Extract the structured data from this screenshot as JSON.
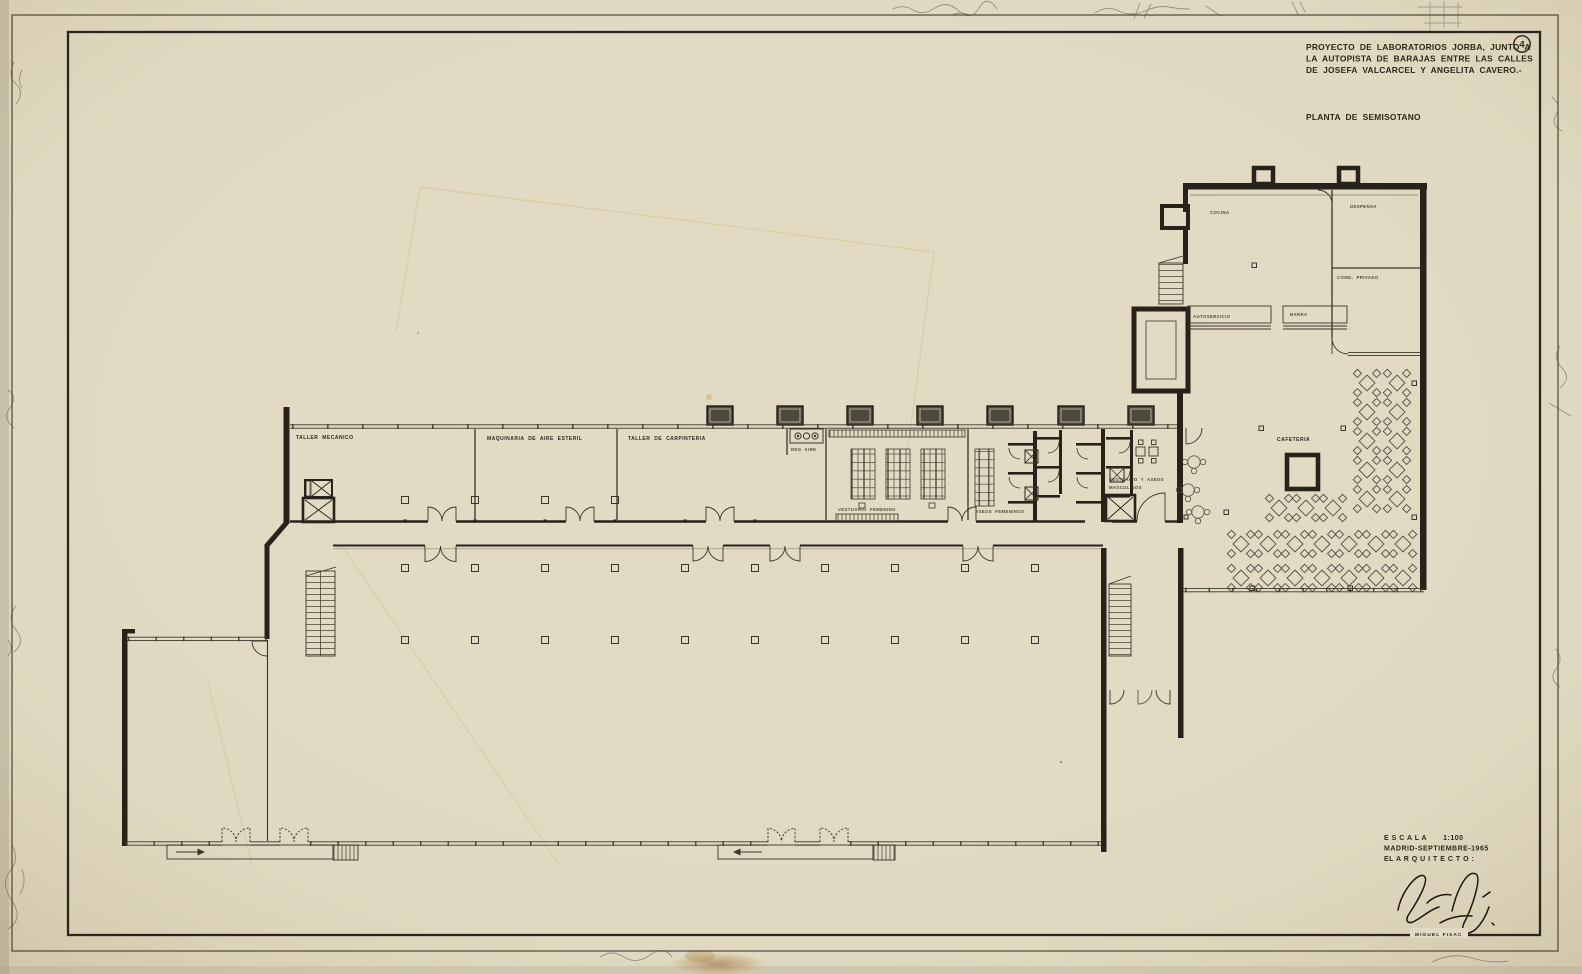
{
  "colors": {
    "paper": "#e2dac3",
    "ink": "#28231a",
    "thin_line": "#3a352b",
    "pencil": "#5d574c",
    "stain": "#b08a4e"
  },
  "sheet": {
    "number": "4",
    "title_line1": "PROYECTO DE LABORATORIOS JORBA, JUNTO A",
    "title_line2": "LA AUTOPISTA DE BARAJAS ENTRE LAS CALLES",
    "title_line3": "DE JOSEFA VALCARCEL Y ANGELITA CAVERO.-",
    "plan_title": "PLANTA DE SEMISOTANO",
    "scale_label": "E S C A L A",
    "scale_value": "1:100",
    "date_line": "MADRID-SEPTIEMBRE-1965",
    "architect_label": "EL  A R Q U I T E C T O :",
    "architect_name": "MIGUEL  FISAC"
  },
  "rooms": {
    "taller_mecanico": "TALLER   MECANICO",
    "maquinaria_aire": "MAQUINARIA   DE   AIRE   ESTERIL",
    "taller_carpinteria": "TALLER   DE   CARPINTERIA",
    "reg_aire": "REG  AIRE",
    "vestuario_femenino": "VESTUARIO   FEMENINO",
    "aseos_femeninos": "ASEOS   FEMENINOS",
    "vestuario_masculino_l1": "VESTUARIO  Y  ASEOS",
    "vestuario_masculino_l2": "MASCULINOS",
    "cafeteria": "CAFETERIA",
    "cocina": "COCINA",
    "despensa": "DESPENSA",
    "comedor_privado": "COMD.   PRIVADO",
    "autoservicio": "AUTOSERVICIO",
    "barra": "BARRA"
  }
}
